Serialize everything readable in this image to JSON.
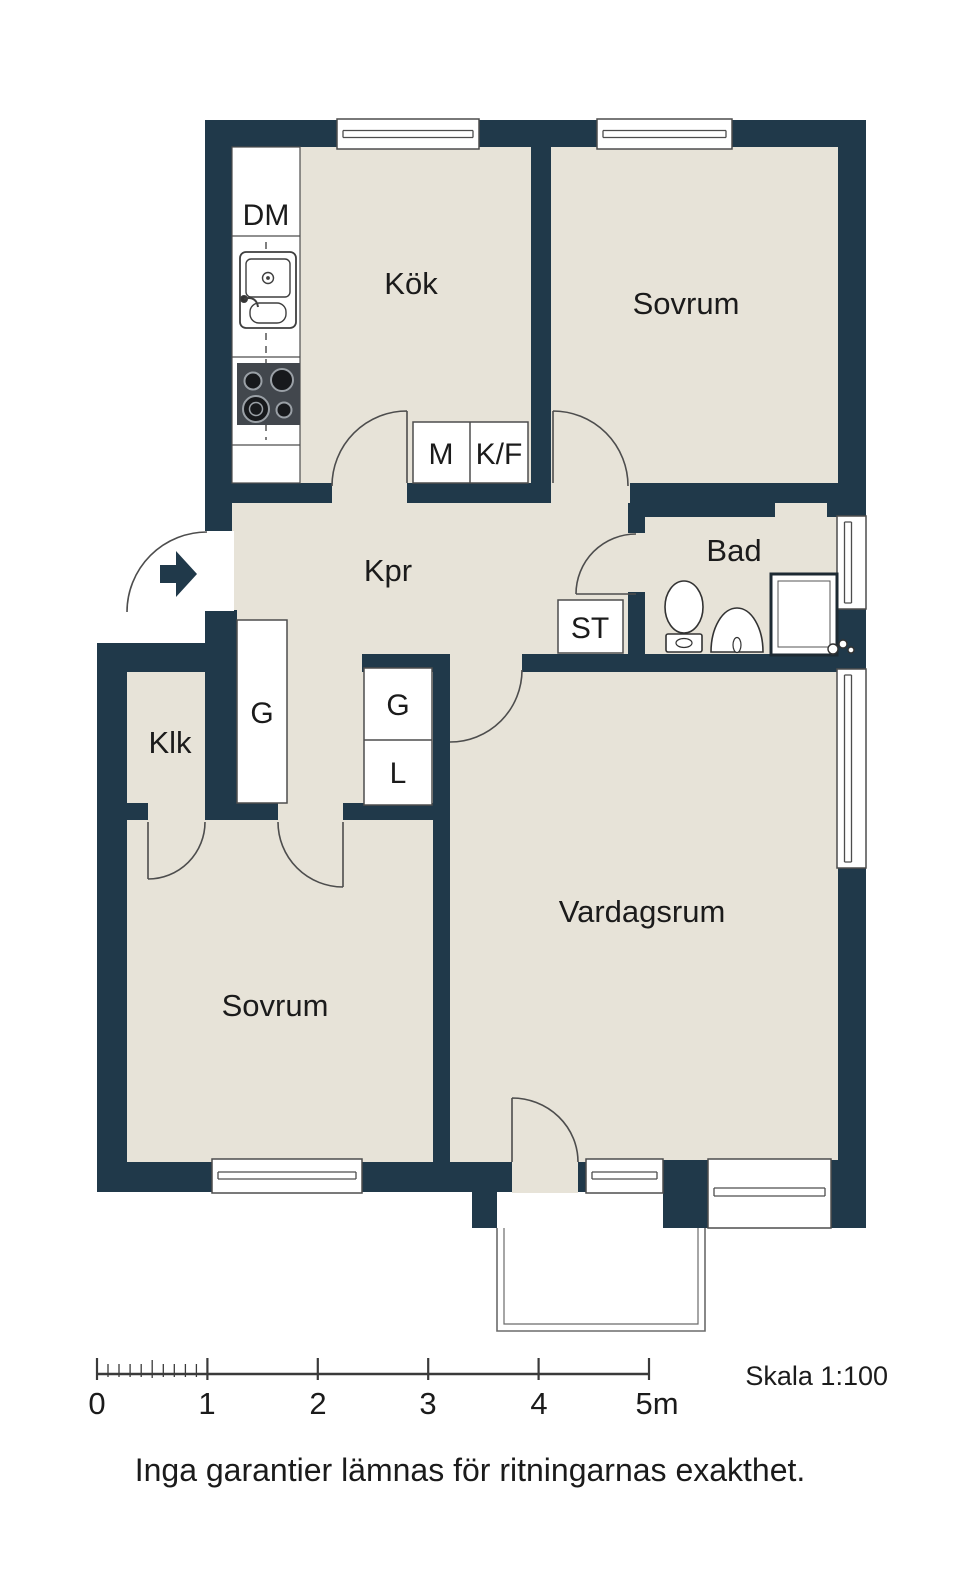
{
  "labels": {
    "kitchen": "Kök",
    "bedroom_top": "Sovrum",
    "bedroom_bottom": "Sovrum",
    "hallway": "Kpr",
    "bathroom": "Bad",
    "closet_room": "Klk",
    "living_room": "Vardagsrum",
    "dishwasher": "DM",
    "microwave": "M",
    "fridge_freezer": "K/F",
    "cleaning_cabinet": "ST",
    "wardrobe_hall": "G",
    "wardrobe_g": "G",
    "wardrobe_l": "L"
  },
  "scale_bar": {
    "ticks": [
      "0",
      "1",
      "2",
      "3",
      "4",
      "5m"
    ],
    "caption": "Skala 1:100"
  },
  "disclaimer": "Inga garantier lämnas för ritningarnas exakthet.",
  "colors": {
    "wall": "#20394a",
    "floor": "#e7e3d8",
    "outline": "#4d4d4d"
  }
}
